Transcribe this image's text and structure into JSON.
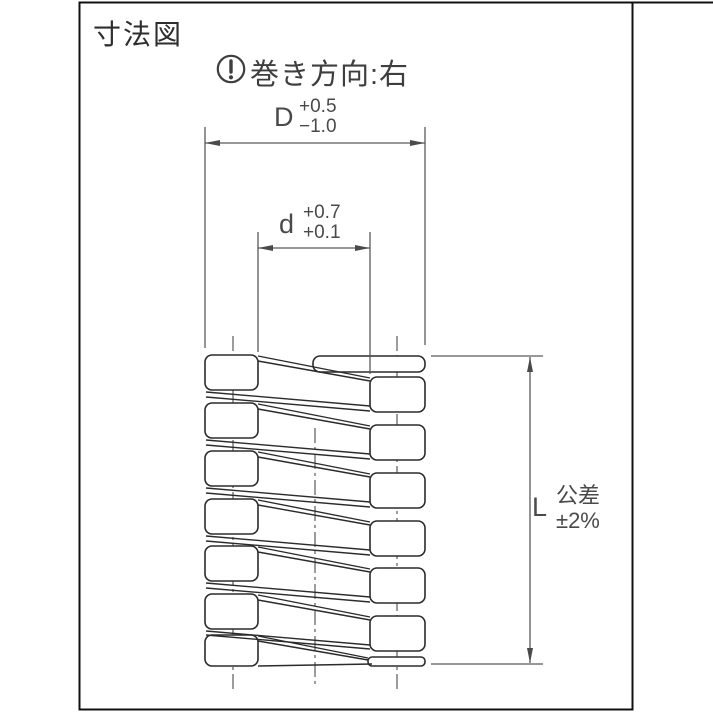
{
  "title": "寸法図",
  "winding_note": {
    "icon": "exclamation-circle-icon",
    "text": "巻き方向:右"
  },
  "dim_D": {
    "label": "D",
    "tol_upper": "+0.5",
    "tol_lower": "−1.0"
  },
  "dim_d": {
    "label": "d",
    "tol_upper": "+0.7",
    "tol_lower": "+0.1"
  },
  "dim_L": {
    "label": "L",
    "tol_label": "公差",
    "tol_value": "±2%"
  },
  "spring": {
    "type": "square-wire coil spring, sectioned side view",
    "left_coil_sections": 7,
    "right_coil_sections": 8,
    "winding_direction": "right"
  },
  "colors": {
    "background": "#ffffff",
    "frame": "#111111",
    "drawing_line": "#2b2b2b",
    "dimension_line": "#5a5a5a",
    "text": "#3a3a3a"
  }
}
